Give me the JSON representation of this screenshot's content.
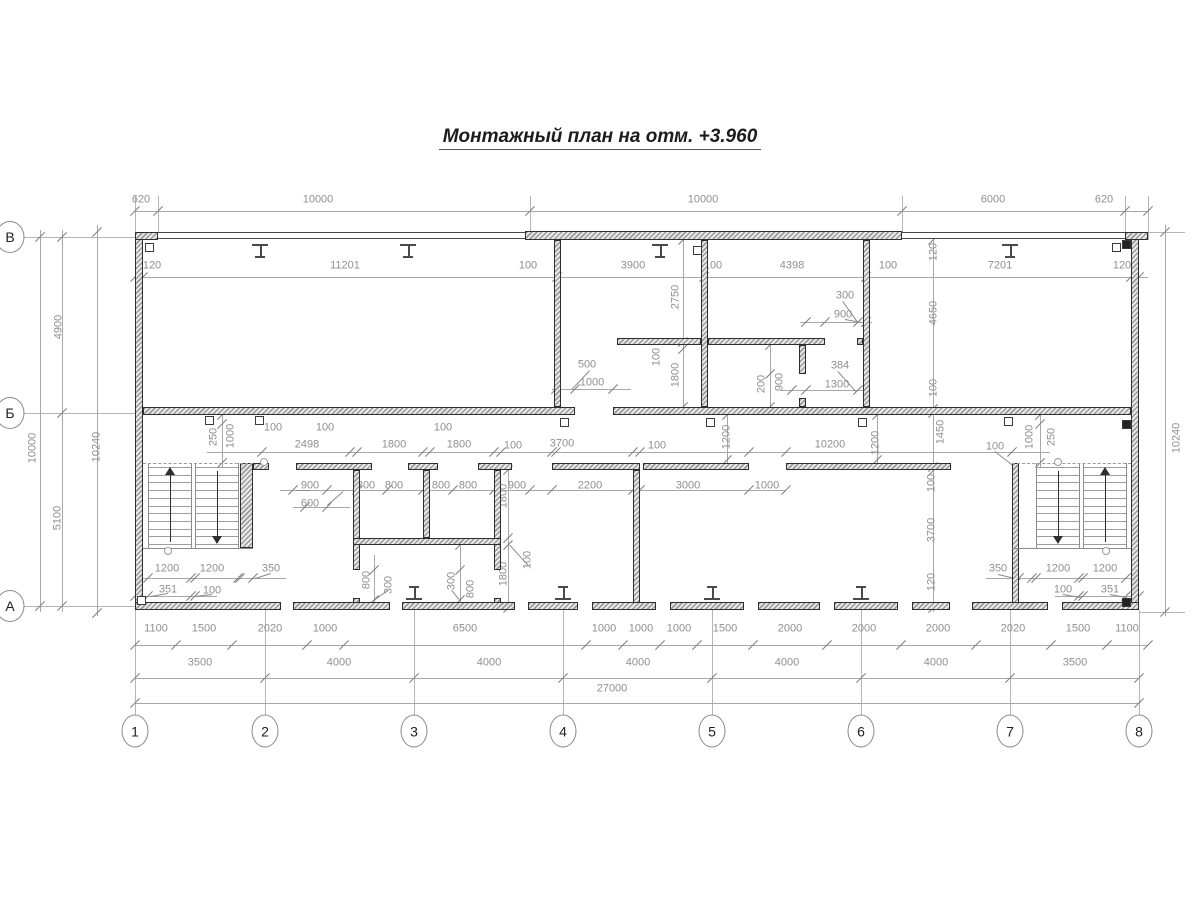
{
  "title": "Монтажный план на отм. +3.960",
  "colors": {
    "wall_edge": "#2e2e2e",
    "dim_text": "#8f8f8f",
    "dim_line": "#a8a8a8",
    "title_text": "#1c1c1c"
  },
  "axes_bottom": [
    {
      "label": "1",
      "x": 135
    },
    {
      "label": "2",
      "x": 265
    },
    {
      "label": "3",
      "x": 414
    },
    {
      "label": "4",
      "x": 563
    },
    {
      "label": "5",
      "x": 712
    },
    {
      "label": "6",
      "x": 861
    },
    {
      "label": "7",
      "x": 1010
    },
    {
      "label": "8",
      "x": 1139
    }
  ],
  "axes_left": [
    {
      "label": "В",
      "y": 237
    },
    {
      "label": "Б",
      "y": 413
    },
    {
      "label": "А",
      "y": 606
    }
  ],
  "chart_data": {
    "type": "floor_plan",
    "overall_width_mm": 27000,
    "overall_height_mm": 10000,
    "column_spacings_mm": [
      3500,
      4000,
      4000,
      4000,
      4000,
      4000,
      3500
    ],
    "row_spacings_mm": {
      "В-Б": 4900,
      "Б-А": 5100
    },
    "outer_depth_mm": 10240
  },
  "dim_labels": [
    [
      "620",
      141,
      200,
      0
    ],
    [
      "10000",
      318,
      200,
      0
    ],
    [
      "10000",
      703,
      200,
      0
    ],
    [
      "6000",
      993,
      200,
      0
    ],
    [
      "620",
      1104,
      200,
      0
    ],
    [
      "120",
      152,
      266,
      0
    ],
    [
      "11201",
      345,
      266,
      0
    ],
    [
      "100",
      528,
      266,
      0
    ],
    [
      "3900",
      633,
      266,
      0
    ],
    [
      "100",
      713,
      266,
      0
    ],
    [
      "4398",
      792,
      266,
      0
    ],
    [
      "100",
      888,
      266,
      0
    ],
    [
      "7201",
      1000,
      266,
      0
    ],
    [
      "120",
      1122,
      266,
      0
    ],
    [
      "300",
      845,
      296,
      0
    ],
    [
      "900",
      843,
      315,
      0
    ],
    [
      "384",
      840,
      366,
      0
    ],
    [
      "1300",
      837,
      385,
      0
    ],
    [
      "500",
      587,
      365,
      0
    ],
    [
      "1000",
      592,
      383,
      0
    ],
    [
      "2750",
      676,
      297,
      1
    ],
    [
      "100",
      657,
      357,
      1
    ],
    [
      "1800",
      676,
      375,
      1
    ],
    [
      "200",
      762,
      384,
      1
    ],
    [
      "900",
      780,
      382,
      1
    ],
    [
      "120",
      934,
      252,
      1
    ],
    [
      "4650",
      934,
      313,
      1
    ],
    [
      "100",
      934,
      388,
      1
    ],
    [
      "1450",
      941,
      432,
      1
    ],
    [
      "100",
      932,
      483,
      1
    ],
    [
      "3700",
      932,
      530,
      1
    ],
    [
      "120",
      932,
      582,
      1
    ],
    [
      "10000",
      33,
      448,
      1
    ],
    [
      "4900",
      59,
      327,
      1
    ],
    [
      "5100",
      58,
      518,
      1
    ],
    [
      "10240",
      97,
      447,
      1
    ],
    [
      "10240",
      1177,
      438,
      1
    ],
    [
      "250",
      214,
      437,
      1
    ],
    [
      "1000",
      231,
      436,
      1
    ],
    [
      "100",
      273,
      428,
      0
    ],
    [
      "100",
      325,
      428,
      0
    ],
    [
      "2498",
      307,
      445,
      0
    ],
    [
      "1800",
      394,
      445,
      0
    ],
    [
      "100",
      443,
      428,
      0
    ],
    [
      "1800",
      459,
      445,
      0
    ],
    [
      "100",
      513,
      446,
      0
    ],
    [
      "3700",
      562,
      444,
      0
    ],
    [
      "100",
      657,
      446,
      0
    ],
    [
      "1200",
      727,
      437,
      1
    ],
    [
      "10200",
      830,
      445,
      0
    ],
    [
      "1200",
      876,
      443,
      1
    ],
    [
      "100",
      995,
      447,
      0
    ],
    [
      "1000",
      1030,
      437,
      1
    ],
    [
      "250",
      1052,
      437,
      1
    ],
    [
      "900",
      310,
      486,
      0
    ],
    [
      "600",
      310,
      504,
      0
    ],
    [
      "800",
      366,
      486,
      0
    ],
    [
      "800",
      394,
      486,
      0
    ],
    [
      "800",
      441,
      486,
      0
    ],
    [
      "800",
      468,
      486,
      0
    ],
    [
      "900",
      517,
      486,
      0
    ],
    [
      "2200",
      590,
      486,
      0
    ],
    [
      "3000",
      688,
      486,
      0
    ],
    [
      "1000",
      767,
      486,
      0
    ],
    [
      "1800",
      504,
      496,
      1
    ],
    [
      "1800",
      504,
      574,
      1
    ],
    [
      "100",
      528,
      560,
      1
    ],
    [
      "800",
      367,
      580,
      1
    ],
    [
      "300",
      389,
      585,
      1
    ],
    [
      "300",
      452,
      581,
      1
    ],
    [
      "800",
      471,
      589,
      1
    ],
    [
      "1200",
      167,
      569,
      0
    ],
    [
      "1200",
      212,
      569,
      0
    ],
    [
      "350",
      271,
      569,
      0
    ],
    [
      "351",
      168,
      590,
      0
    ],
    [
      "100",
      212,
      591,
      0
    ],
    [
      "350",
      998,
      569,
      0
    ],
    [
      "1200",
      1058,
      569,
      0
    ],
    [
      "1200",
      1105,
      569,
      0
    ],
    [
      "100",
      1063,
      590,
      0
    ],
    [
      "351",
      1110,
      590,
      0
    ],
    [
      "1100",
      156,
      629,
      0
    ],
    [
      "1500",
      204,
      629,
      0
    ],
    [
      "2020",
      270,
      629,
      0
    ],
    [
      "1000",
      325,
      629,
      0
    ],
    [
      "6500",
      465,
      629,
      0
    ],
    [
      "1000",
      604,
      629,
      0
    ],
    [
      "1000",
      641,
      629,
      0
    ],
    [
      "1000",
      679,
      629,
      0
    ],
    [
      "1500",
      725,
      629,
      0
    ],
    [
      "2000",
      790,
      629,
      0
    ],
    [
      "2000",
      864,
      629,
      0
    ],
    [
      "2000",
      938,
      629,
      0
    ],
    [
      "2020",
      1013,
      629,
      0
    ],
    [
      "1500",
      1078,
      629,
      0
    ],
    [
      "1100",
      1127,
      629,
      0
    ],
    [
      "3500",
      200,
      663,
      0
    ],
    [
      "4000",
      339,
      663,
      0
    ],
    [
      "4000",
      489,
      663,
      0
    ],
    [
      "4000",
      638,
      663,
      0
    ],
    [
      "4000",
      787,
      663,
      0
    ],
    [
      "4000",
      936,
      663,
      0
    ],
    [
      "3500",
      1075,
      663,
      0
    ],
    [
      "27000",
      612,
      689,
      0
    ]
  ],
  "dim_lines_h": [
    {
      "y": 211,
      "x1": 135,
      "x2": 1148,
      "ticks": [
        135,
        158,
        530,
        902,
        1125,
        1148
      ]
    },
    {
      "y": 277,
      "x1": 135,
      "x2": 1148,
      "ticks": [
        135,
        143,
        557,
        704,
        866,
        1131,
        1139
      ]
    },
    {
      "y": 452,
      "x1": 207,
      "x2": 1050,
      "ticks": [
        262,
        350,
        357,
        423,
        430,
        494,
        501,
        552,
        556,
        633,
        640,
        749,
        786,
        1012
      ]
    },
    {
      "y": 490,
      "x1": 280,
      "x2": 786,
      "ticks": [
        293,
        327,
        357,
        387,
        423,
        453,
        494,
        530,
        552,
        633,
        640,
        749,
        786
      ]
    },
    {
      "y": 507,
      "x1": 293,
      "x2": 350,
      "ticks": [
        305,
        327
      ]
    },
    {
      "y": 389,
      "x1": 552,
      "x2": 631,
      "ticks": [
        556,
        575,
        613
      ]
    },
    {
      "y": 390,
      "x1": 780,
      "x2": 870,
      "ticks": [
        792,
        806,
        858
      ]
    },
    {
      "y": 322,
      "x1": 800,
      "x2": 872,
      "ticks": [
        806,
        825,
        858,
        866
      ]
    },
    {
      "y": 578,
      "x1": 135,
      "x2": 286,
      "ticks": [
        148,
        191,
        195,
        238,
        240,
        253
      ]
    },
    {
      "y": 596,
      "x1": 135,
      "x2": 217,
      "ticks": [
        135,
        148,
        191,
        195
      ]
    },
    {
      "y": 578,
      "x1": 986,
      "x2": 1139,
      "ticks": [
        1019,
        1032,
        1036,
        1079,
        1083,
        1126
      ]
    },
    {
      "y": 596,
      "x1": 1055,
      "x2": 1139,
      "ticks": [
        1079,
        1083,
        1126,
        1139
      ]
    },
    {
      "y": 645,
      "x1": 135,
      "x2": 1148,
      "ticks": [
        135,
        176,
        232,
        307,
        344,
        586,
        623,
        660,
        697,
        753,
        827,
        901,
        976,
        1051,
        1107,
        1148
      ]
    },
    {
      "y": 678,
      "x1": 135,
      "x2": 1139,
      "ticks": [
        135,
        265,
        414,
        563,
        712,
        861,
        1010,
        1139
      ]
    },
    {
      "y": 703,
      "x1": 135,
      "x2": 1139,
      "ticks": [
        135,
        1139
      ]
    }
  ],
  "dim_lines_v": [
    {
      "x": 40,
      "y1": 230,
      "y2": 612,
      "ticks": [
        237,
        606
      ]
    },
    {
      "x": 62,
      "y1": 230,
      "y2": 612,
      "ticks": [
        237,
        413,
        606
      ]
    },
    {
      "x": 97,
      "y1": 225,
      "y2": 616,
      "ticks": [
        232,
        613
      ]
    },
    {
      "x": 1165,
      "y1": 225,
      "y2": 616,
      "ticks": [
        232,
        612
      ]
    },
    {
      "x": 683,
      "y1": 240,
      "y2": 410,
      "ticks": [
        240,
        342,
        349,
        407
      ]
    },
    {
      "x": 933,
      "y1": 232,
      "y2": 612,
      "ticks": [
        240,
        409,
        413,
        467,
        471,
        608
      ]
    },
    {
      "x": 222,
      "y1": 413,
      "y2": 467,
      "ticks": [
        415,
        424,
        463
      ]
    },
    {
      "x": 1040,
      "y1": 413,
      "y2": 467,
      "ticks": [
        415,
        424,
        463
      ]
    },
    {
      "x": 727,
      "y1": 413,
      "y2": 467,
      "ticks": [
        415,
        460
      ]
    },
    {
      "x": 877,
      "y1": 413,
      "y2": 467,
      "ticks": [
        415,
        460
      ]
    },
    {
      "x": 508,
      "y1": 463,
      "y2": 610,
      "ticks": [
        470,
        538,
        545,
        608
      ]
    },
    {
      "x": 770,
      "y1": 338,
      "y2": 410,
      "ticks": [
        345,
        374,
        407
      ]
    },
    {
      "x": 374,
      "y1": 555,
      "y2": 606,
      "ticks": [
        570,
        600
      ]
    },
    {
      "x": 460,
      "y1": 538,
      "y2": 606,
      "ticks": [
        545,
        570,
        600
      ]
    }
  ],
  "ext_lines": [
    {
      "x1": 158,
      "y1": 196,
      "x2": 158,
      "y2": 232
    },
    {
      "x1": 530,
      "y1": 196,
      "x2": 530,
      "y2": 232
    },
    {
      "x1": 902,
      "y1": 196,
      "x2": 902,
      "y2": 232
    },
    {
      "x1": 1125,
      "y1": 196,
      "x2": 1125,
      "y2": 232
    },
    {
      "x1": 1148,
      "y1": 196,
      "x2": 1148,
      "y2": 240
    },
    {
      "x1": 135,
      "y1": 196,
      "x2": 135,
      "y2": 232
    },
    {
      "x1": 135,
      "y1": 610,
      "x2": 135,
      "y2": 716
    },
    {
      "x1": 265,
      "y1": 610,
      "x2": 265,
      "y2": 716
    },
    {
      "x1": 414,
      "y1": 610,
      "x2": 414,
      "y2": 716
    },
    {
      "x1": 563,
      "y1": 610,
      "x2": 563,
      "y2": 716
    },
    {
      "x1": 712,
      "y1": 610,
      "x2": 712,
      "y2": 716
    },
    {
      "x1": 861,
      "y1": 610,
      "x2": 861,
      "y2": 716
    },
    {
      "x1": 1010,
      "y1": 610,
      "x2": 1010,
      "y2": 716
    },
    {
      "x1": 1139,
      "y1": 610,
      "x2": 1139,
      "y2": 716
    },
    {
      "x1": 24,
      "y1": 237,
      "x2": 135,
      "y2": 237
    },
    {
      "x1": 24,
      "y1": 413,
      "x2": 135,
      "y2": 413
    },
    {
      "x1": 24,
      "y1": 606,
      "x2": 135,
      "y2": 606
    },
    {
      "x1": 1139,
      "y1": 232,
      "x2": 1185,
      "y2": 232
    },
    {
      "x1": 1139,
      "y1": 612,
      "x2": 1185,
      "y2": 612
    }
  ],
  "walls": [
    {
      "x": 135,
      "y": 232,
      "w": 8,
      "h": 378,
      "k": "h"
    },
    {
      "x": 1131,
      "y": 232,
      "w": 8,
      "h": 378,
      "k": "h"
    },
    {
      "x": 135,
      "y": 232,
      "w": 23,
      "h": 8,
      "k": "h"
    },
    {
      "x": 1125,
      "y": 232,
      "w": 23,
      "h": 8,
      "k": "h"
    },
    {
      "x": 158,
      "y": 232,
      "w": 967,
      "h": 7,
      "k": "t"
    },
    {
      "x": 525,
      "y": 231,
      "w": 377,
      "h": 9,
      "k": "h"
    },
    {
      "x": 143,
      "y": 407,
      "w": 432,
      "h": 8,
      "k": "h"
    },
    {
      "x": 613,
      "y": 407,
      "w": 518,
      "h": 8,
      "k": "h"
    },
    {
      "x": 554,
      "y": 240,
      "w": 7,
      "h": 167,
      "k": "h"
    },
    {
      "x": 701,
      "y": 240,
      "w": 7,
      "h": 167,
      "k": "h"
    },
    {
      "x": 863,
      "y": 240,
      "w": 7,
      "h": 167,
      "k": "h"
    },
    {
      "x": 617,
      "y": 338,
      "w": 84,
      "h": 7,
      "k": "h"
    },
    {
      "x": 708,
      "y": 338,
      "w": 117,
      "h": 7,
      "k": "h"
    },
    {
      "x": 857,
      "y": 338,
      "w": 6,
      "h": 7,
      "k": "h"
    },
    {
      "x": 799,
      "y": 345,
      "w": 7,
      "h": 29,
      "k": "h"
    },
    {
      "x": 799,
      "y": 398,
      "w": 7,
      "h": 9,
      "k": "h"
    },
    {
      "x": 135,
      "y": 602,
      "w": 146,
      "h": 8,
      "k": "h"
    },
    {
      "x": 293,
      "y": 602,
      "w": 97,
      "h": 8,
      "k": "h"
    },
    {
      "x": 402,
      "y": 602,
      "w": 113,
      "h": 8,
      "k": "h"
    },
    {
      "x": 528,
      "y": 602,
      "w": 50,
      "h": 8,
      "k": "h"
    },
    {
      "x": 592,
      "y": 602,
      "w": 64,
      "h": 8,
      "k": "h"
    },
    {
      "x": 670,
      "y": 602,
      "w": 74,
      "h": 8,
      "k": "h"
    },
    {
      "x": 758,
      "y": 602,
      "w": 62,
      "h": 8,
      "k": "h"
    },
    {
      "x": 834,
      "y": 602,
      "w": 64,
      "h": 8,
      "k": "h"
    },
    {
      "x": 912,
      "y": 602,
      "w": 38,
      "h": 8,
      "k": "h"
    },
    {
      "x": 972,
      "y": 602,
      "w": 76,
      "h": 8,
      "k": "h"
    },
    {
      "x": 1062,
      "y": 602,
      "w": 77,
      "h": 8,
      "k": "h"
    },
    {
      "x": 240,
      "y": 463,
      "w": 13,
      "h": 85,
      "k": "h"
    },
    {
      "x": 353,
      "y": 470,
      "w": 7,
      "h": 100,
      "k": "h"
    },
    {
      "x": 353,
      "y": 598,
      "w": 7,
      "h": 5,
      "k": "h"
    },
    {
      "x": 423,
      "y": 470,
      "w": 7,
      "h": 68,
      "k": "h"
    },
    {
      "x": 494,
      "y": 470,
      "w": 7,
      "h": 100,
      "k": "h"
    },
    {
      "x": 494,
      "y": 598,
      "w": 7,
      "h": 5,
      "k": "h"
    },
    {
      "x": 353,
      "y": 538,
      "w": 148,
      "h": 7,
      "k": "h"
    },
    {
      "x": 253,
      "y": 463,
      "w": 16,
      "h": 7,
      "k": "h"
    },
    {
      "x": 296,
      "y": 463,
      "w": 76,
      "h": 7,
      "k": "h"
    },
    {
      "x": 408,
      "y": 463,
      "w": 30,
      "h": 7,
      "k": "h"
    },
    {
      "x": 478,
      "y": 463,
      "w": 34,
      "h": 7,
      "k": "h"
    },
    {
      "x": 552,
      "y": 463,
      "w": 88,
      "h": 7,
      "k": "h"
    },
    {
      "x": 643,
      "y": 463,
      "w": 106,
      "h": 7,
      "k": "h"
    },
    {
      "x": 786,
      "y": 463,
      "w": 165,
      "h": 7,
      "k": "h"
    },
    {
      "x": 633,
      "y": 470,
      "w": 7,
      "h": 133,
      "k": "h"
    },
    {
      "x": 1012,
      "y": 463,
      "w": 7,
      "h": 140,
      "k": "h"
    }
  ],
  "clips": [
    {
      "x": 145,
      "y": 243,
      "f": 0
    },
    {
      "x": 1112,
      "y": 243,
      "f": 0
    },
    {
      "x": 693,
      "y": 246,
      "f": 0
    },
    {
      "x": 205,
      "y": 416,
      "f": 0
    },
    {
      "x": 255,
      "y": 416,
      "f": 0
    },
    {
      "x": 560,
      "y": 418,
      "f": 0
    },
    {
      "x": 706,
      "y": 418,
      "f": 0
    },
    {
      "x": 858,
      "y": 418,
      "f": 0
    },
    {
      "x": 1004,
      "y": 417,
      "f": 0
    },
    {
      "x": 1122,
      "y": 240,
      "f": 1
    },
    {
      "x": 1122,
      "y": 420,
      "f": 1
    },
    {
      "x": 1122,
      "y": 598,
      "f": 1
    },
    {
      "x": 137,
      "y": 596,
      "f": 0
    }
  ],
  "columns_top": [
    260,
    408,
    660,
    1010
  ],
  "columns_bottom": [
    414,
    563,
    712,
    861
  ],
  "stairs": {
    "left": {
      "flights": [
        {
          "x": 148,
          "y": 463,
          "w": 43,
          "h": 85,
          "arrow": "up"
        },
        {
          "x": 195,
          "y": 463,
          "w": 43,
          "h": 85,
          "arrow": "down"
        }
      ],
      "dashed": {
        "x1": 143,
        "y": 463,
        "x2": 253
      },
      "landing": {
        "x1": 143,
        "y": 548,
        "x2": 253
      },
      "circles": [
        {
          "x": 168,
          "y": 551
        },
        {
          "x": 264,
          "y": 462
        }
      ]
    },
    "right": {
      "flights": [
        {
          "x": 1036,
          "y": 463,
          "w": 43,
          "h": 85,
          "arrow": "down"
        },
        {
          "x": 1083,
          "y": 463,
          "w": 43,
          "h": 85,
          "arrow": "up"
        }
      ],
      "dashed": {
        "x1": 1012,
        "y": 463,
        "x2": 1131
      },
      "landing": {
        "x1": 1012,
        "y": 548,
        "x2": 1131
      },
      "circles": [
        {
          "x": 1058,
          "y": 462
        },
        {
          "x": 1106,
          "y": 551
        }
      ]
    }
  },
  "leaders": [
    [
      327,
      505,
      343,
      491
    ],
    [
      590,
      371,
      572,
      390
    ],
    [
      838,
      371,
      856,
      391
    ],
    [
      843,
      301,
      858,
      322
    ],
    [
      845,
      319,
      862,
      322
    ],
    [
      271,
      574,
      255,
      579
    ],
    [
      168,
      594,
      150,
      597
    ],
    [
      212,
      595,
      194,
      597
    ],
    [
      995,
      451,
      1013,
      465
    ],
    [
      998,
      574,
      1020,
      579
    ],
    [
      1063,
      594,
      1081,
      597
    ],
    [
      1110,
      594,
      1127,
      597
    ],
    [
      389,
      590,
      374,
      601
    ],
    [
      452,
      590,
      461,
      601
    ],
    [
      310,
      491,
      296,
      491
    ],
    [
      528,
      566,
      509,
      545
    ]
  ]
}
